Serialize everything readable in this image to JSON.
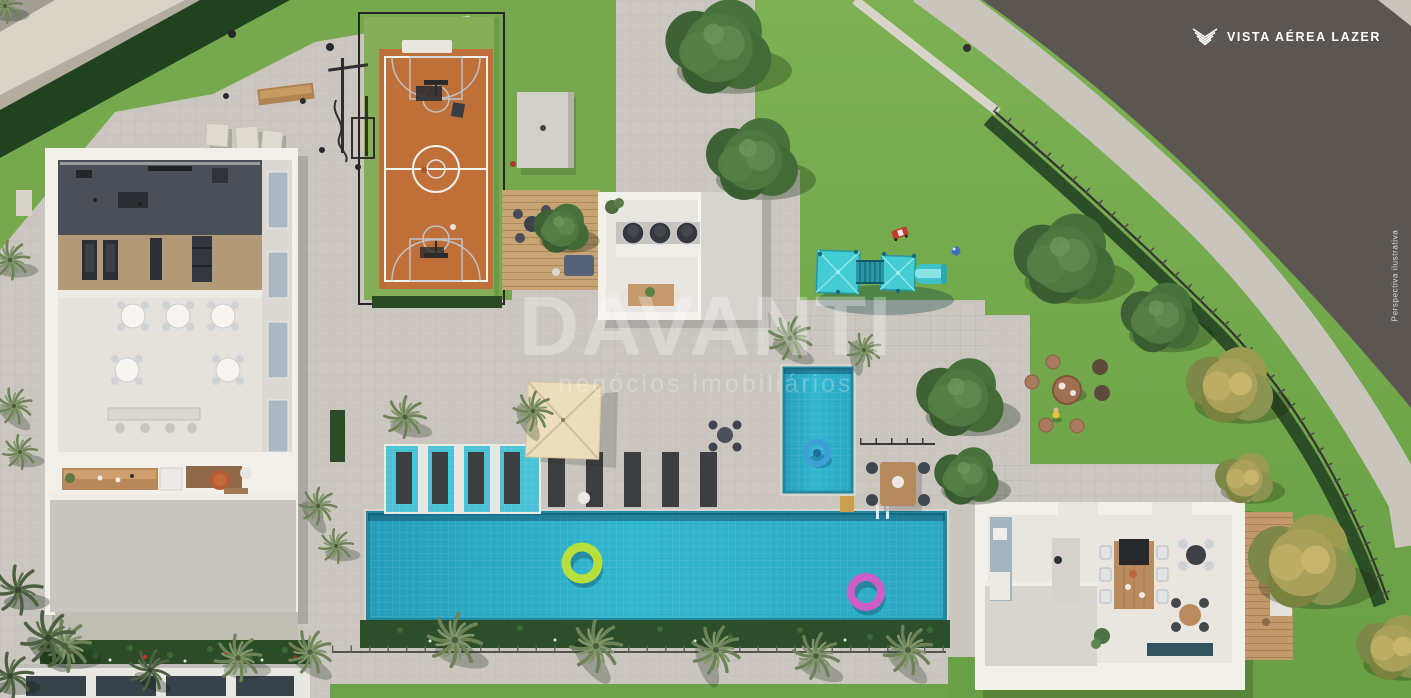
{
  "header": {
    "logo_icon": "chevron-emblem-icon",
    "view_label": "VISTA AÉREA LAZER"
  },
  "watermark": {
    "title": "DAVANTI",
    "subtitle": "negócios imobiliários"
  },
  "footnote": {
    "disclaimer": "Perspectiva ilustrativa"
  },
  "palette": {
    "asphalt": "#5b5651",
    "sidewalk": "#c9c4bc",
    "deck_pavers": "#cbc7c0",
    "lawn": "#76a94e",
    "hedge": "#27461f",
    "court_orange": "#bf6f38",
    "court_border_green": "#84ae58",
    "pool_water": "#2fb2cb",
    "kids_pool_water": "#2fb2cb",
    "playground_teal": "#43ccd2",
    "shade_sail": "#e9dcba",
    "wood_deck": "#c7a473",
    "float_green": "#b8e03c",
    "float_pink": "#cb5ec9",
    "float_blue": "#3f9fd8",
    "building_walls": "#f2f0ea",
    "label_text": "#ffffff"
  },
  "scene": {
    "elements": [
      "curved-street",
      "sidewalk",
      "perimeter-fence",
      "perimeter-hedge",
      "lawn",
      "basketball-court",
      "outdoor-gym",
      "wooden-bench",
      "fitness-center-building",
      "party-room-tables",
      "reception-desk",
      "barbecue-kiosk",
      "pergola-wood-deck",
      "storage-slab",
      "shade-sail",
      "main-swimming-pool",
      "sun-shelf-loungers",
      "deck-loungers",
      "kids-pool",
      "pool-float-green",
      "pool-float-pink",
      "pool-float-blue",
      "pool-ladder",
      "poolside-dining-table",
      "playground",
      "toy-car",
      "ball",
      "picnic-stools",
      "gourmet-pavilion",
      "dining-table",
      "kitchen-island",
      "wood-side-deck",
      "palm-trees",
      "shade-trees",
      "flowering-trees",
      "pool-railing",
      "facade-windows"
    ]
  }
}
